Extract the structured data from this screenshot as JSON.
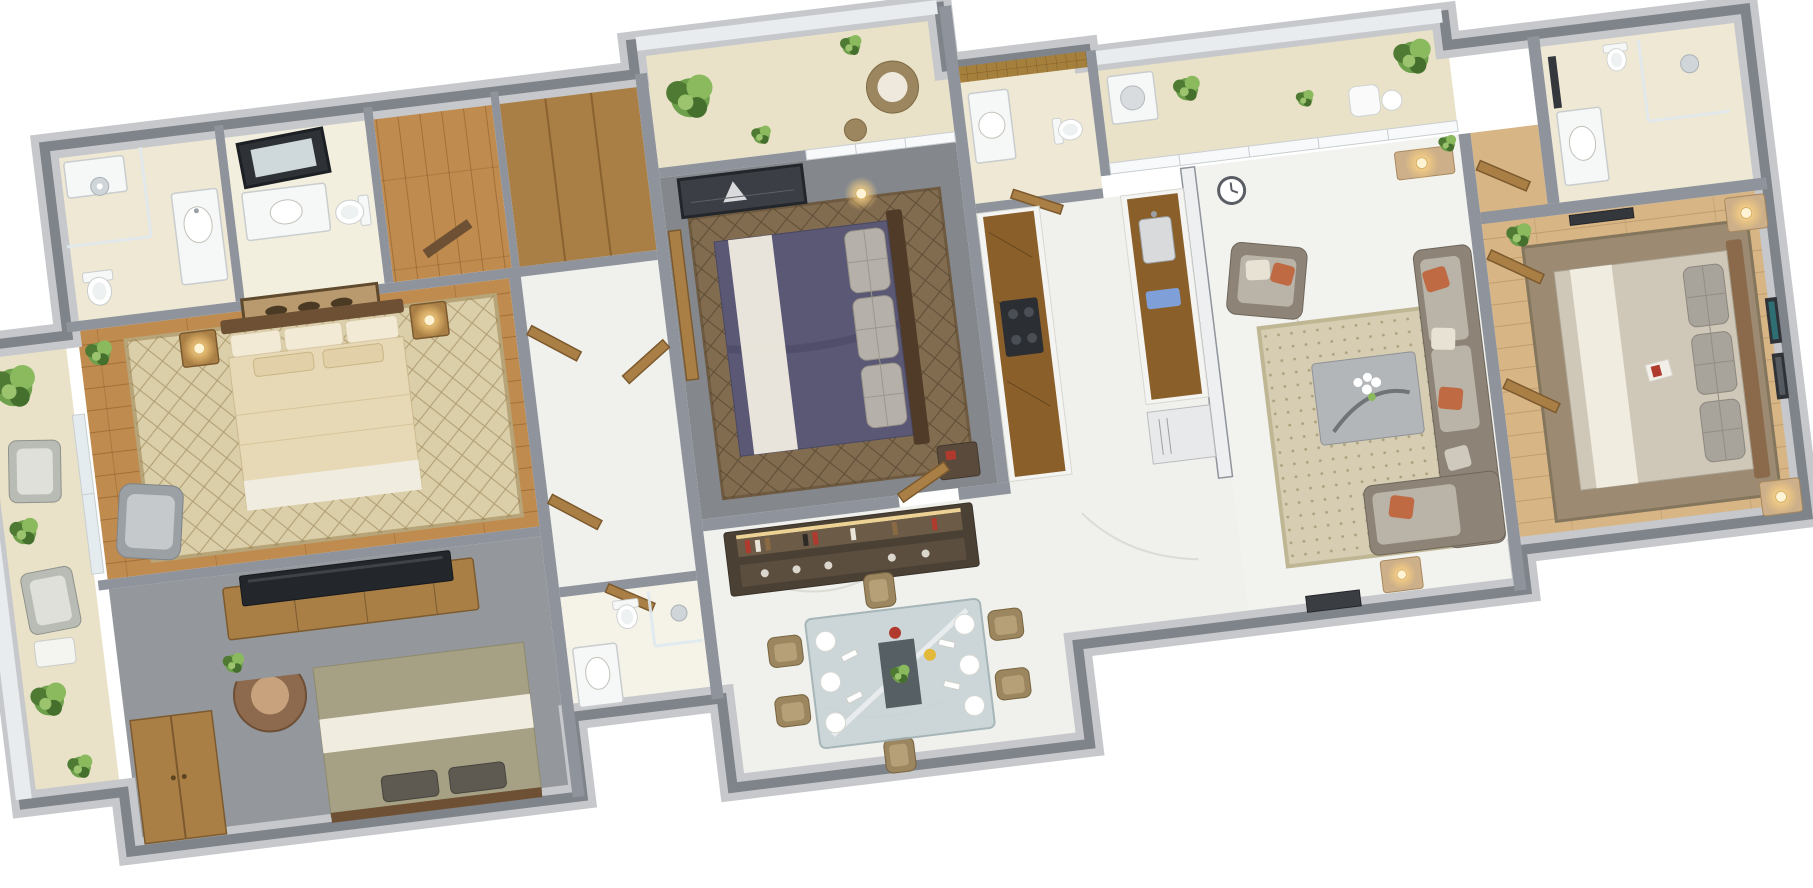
{
  "scene": {
    "type": "3d-floor-plan-render",
    "view": "isometric top-down, rotated slightly counterclockwise",
    "background": "#ffffff",
    "plan_rotation_deg": -7
  },
  "palette": {
    "background": "#ffffff",
    "wall_dark": "#7f838a",
    "wall_mid": "#8f939b",
    "wall_light": "#c6c8cb",
    "wall_white": "#edeff1",
    "marble": "#f0f0ec",
    "cream_tile": "#efe8d4",
    "balcony_floor": "#e9e2c8",
    "wood_floor": "#c08b4e",
    "wood_floor_light": "#d7b585",
    "wood_furniture": "#a97f46",
    "wood_dark": "#6e5134",
    "gray_floor": "#84888d",
    "concrete_floor": "#94989c",
    "rug_beige": "#dbcfa9",
    "rug_brown": "#826c50",
    "rug_taupe": "#9c8b72",
    "rug_living": "#d6cdb2",
    "duvet_beige": "#e7d8b6",
    "duvet_purple": "#5b5875",
    "duvet_olive": "#a6a184",
    "duvet_gray": "#cfc7b8",
    "linen_white": "#f1ece0",
    "sofa_gray": "#8d8377",
    "cushion_light": "#b9b3a8",
    "rust": "#bf6a43",
    "plant_green": "#6fa04c",
    "plant_dark": "#4e7a33",
    "lamp_glow": "#ffd27e",
    "glass_blue": "#dfe9ee",
    "bar_wood": "#4a4034",
    "steel": "#e8e9ea",
    "counter_gold": "#8a5f2a",
    "mosaic_gold": "#a5803c",
    "tv_black": "#23262b",
    "red_accent": "#b03a2e",
    "towel_blue": "#7f9fd8",
    "wicker": "#9c8660"
  },
  "rooms": [
    {
      "name": "left-balcony",
      "items": [
        "potted plants",
        "lounge chairs",
        "side table",
        "glass railing"
      ]
    },
    {
      "name": "master-bathroom",
      "items": [
        "walk-in shower",
        "washbasin vanity",
        "toilet"
      ]
    },
    {
      "name": "guest-bathroom",
      "items": [
        "leaning mirror",
        "washbasin vanity",
        "toilet"
      ]
    },
    {
      "name": "dressing-area",
      "items": [
        "wooden door",
        "wood floor"
      ]
    },
    {
      "name": "walk-in-wardrobe",
      "items": [
        "built-in wardrobe"
      ]
    },
    {
      "name": "master-bedroom",
      "items": [
        "double bed",
        "bedside lamps",
        "horse wall art",
        "diamond patterned rug",
        "lounge chair",
        "potted plant"
      ]
    },
    {
      "name": "bedroom-bottom-left",
      "items": [
        "double bed with olive duvet",
        "tv console",
        "flat tv",
        "curved bronze chair",
        "wardrobe",
        "potted plant"
      ]
    },
    {
      "name": "hallway",
      "items": [
        "wooden doors",
        "marble floor"
      ]
    },
    {
      "name": "hall-bathroom",
      "items": [
        "washbasin vanity",
        "glass shower",
        "toilet"
      ]
    },
    {
      "name": "bedroom-2-balcony",
      "items": [
        "potted plants",
        "wicker chair with cushion",
        "glass partition"
      ]
    },
    {
      "name": "bedroom-2",
      "items": [
        "double bed with purple duvet",
        "white runner",
        "quilted gray pillows",
        "seascape wall art",
        "glowing ball lamp",
        "brown rug",
        "dark nightstand"
      ]
    },
    {
      "name": "bar-unit",
      "items": [
        "bottle shelf",
        "glasses",
        "display lighting"
      ]
    },
    {
      "name": "dining-area",
      "items": [
        "glass dining table",
        "six wicker chairs",
        "white plates",
        "napkins",
        "centerpiece plant",
        "red dish",
        "yellow dish"
      ]
    },
    {
      "name": "kitchen-bathroom",
      "items": [
        "gold mosaic wall",
        "round washbasin",
        "toilet"
      ]
    },
    {
      "name": "kitchen",
      "items": [
        "parallel counters with gold marble tops",
        "cooktop",
        "steel sink",
        "refrigerator",
        "blue towel"
      ]
    },
    {
      "name": "service-balcony",
      "items": [
        "washing machine",
        "potted plants",
        "outdoor chair",
        "side table",
        "glass partition"
      ]
    },
    {
      "name": "living-room",
      "items": [
        "gray armchair",
        "corner sofa with rust cushions",
        "gray coffee table",
        "white flowers",
        "honeycomb rug",
        "wall clock",
        "console with lamp",
        "side table lamp",
        "entry door panel"
      ]
    },
    {
      "name": "bedroom-3-lobby",
      "items": [
        "wooden door",
        "wood floor"
      ]
    },
    {
      "name": "bedroom-3",
      "items": [
        "double bed with gray duvet",
        "quilted pillows",
        "white runner",
        "nightstands",
        "bedside lamps",
        "taupe rug",
        "wall frames",
        "mirror",
        "potted plant",
        "red accent",
        "closet doors"
      ]
    },
    {
      "name": "bedroom-3-bathroom",
      "items": [
        "glass shower",
        "washbasin vanity",
        "wall mirror"
      ]
    }
  ]
}
